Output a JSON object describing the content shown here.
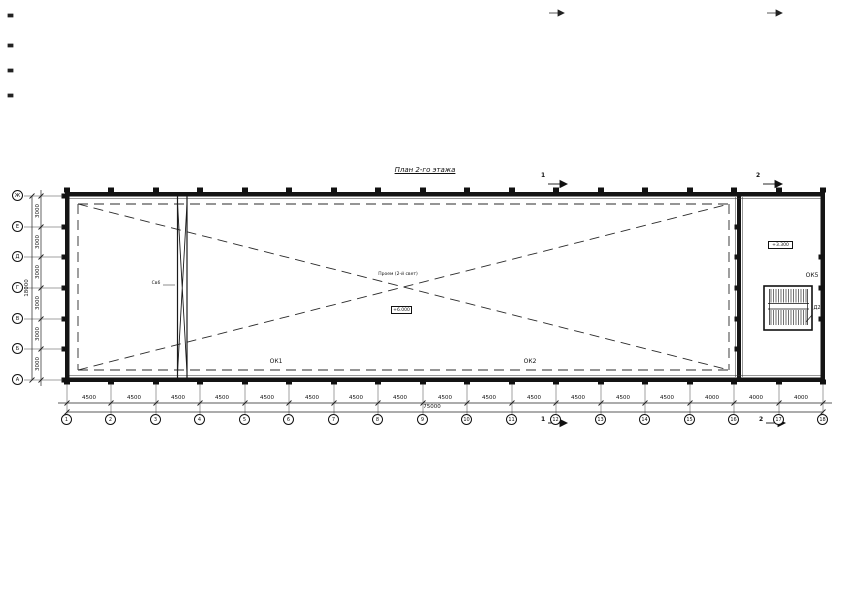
{
  "title": "План 2-го этажа",
  "axes": {
    "bottom": {
      "labels": [
        "1",
        "2",
        "3",
        "4",
        "5",
        "6",
        "7",
        "8",
        "9",
        "10",
        "11",
        "12",
        "13",
        "14",
        "15",
        "16",
        "17",
        "18"
      ],
      "bay_dims": [
        "4500",
        "4500",
        "4500",
        "4500",
        "4500",
        "4500",
        "4500",
        "4500",
        "4500",
        "4500",
        "4500",
        "4500",
        "4500",
        "4500",
        "4000",
        "4000",
        "4000"
      ],
      "total_dim": "75000"
    },
    "left": {
      "labels": [
        "Ж",
        "Е",
        "Д",
        "Г",
        "В",
        "Б",
        "А"
      ],
      "bay_dims": [
        "3000",
        "3000",
        "3000",
        "3000",
        "3000",
        "3000"
      ],
      "total_dim": "18000"
    }
  },
  "annotations": {
    "ok1": "ОК1",
    "ok2": "ОК2",
    "ok5": "ОК5",
    "door": "Д2",
    "brace": "Св6",
    "void_note": "Проем (2-й свет)",
    "elev_center": "+6.000",
    "elev_stair": "+3.300",
    "section_1": "1",
    "section_2": "2"
  },
  "colors": {
    "line": "#1a1a1a",
    "paper": "#ffffff"
  }
}
